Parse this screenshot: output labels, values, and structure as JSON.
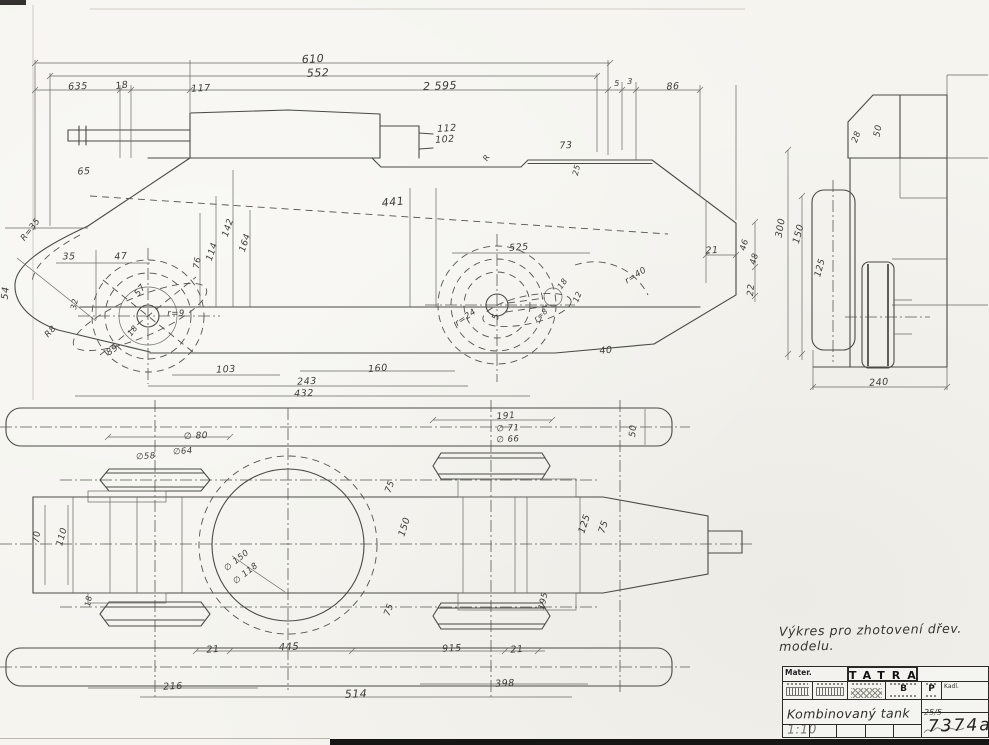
{
  "sheet": {
    "note": "Výkres pro zhotovení dřev. modelu.",
    "colors": {
      "paper": "#f5f4ef",
      "ink": "#4a4a46",
      "dark": "#161614"
    }
  },
  "title_block": {
    "mater_label": "Mater.",
    "brand": "TATRA",
    "cell_b": "B",
    "cell_p": "P",
    "kadl_label": "Kadl.",
    "drawing_title": "Kombinovaný tank 1:10",
    "date": "25/5",
    "drawing_number": "7374a"
  },
  "labels": [
    {
      "t": "635",
      "x": 78,
      "y": 87,
      "r": -2
    },
    {
      "t": "18",
      "x": 122,
      "y": 86,
      "r": -8
    },
    {
      "t": "117",
      "x": 201,
      "y": 89,
      "r": -3
    },
    {
      "t": "610",
      "x": 313,
      "y": 59,
      "r": -3,
      "fs": 11
    },
    {
      "t": "552",
      "x": 318,
      "y": 73,
      "r": -2,
      "fs": 11
    },
    {
      "t": "2 595",
      "x": 440,
      "y": 86,
      "r": -2,
      "fs": 11
    },
    {
      "t": "5",
      "x": 617,
      "y": 84,
      "r": 0,
      "fs": 8
    },
    {
      "t": "3",
      "x": 630,
      "y": 82,
      "r": 0,
      "fs": 8
    },
    {
      "t": "86",
      "x": 673,
      "y": 87,
      "r": -3
    },
    {
      "t": "112",
      "x": 447,
      "y": 129,
      "r": -4
    },
    {
      "t": "102",
      "x": 445,
      "y": 140,
      "r": -4
    },
    {
      "t": "73",
      "x": 566,
      "y": 146,
      "r": -3
    },
    {
      "t": "25",
      "x": 577,
      "y": 170,
      "r": -78,
      "fs": 8
    },
    {
      "t": "R",
      "x": 487,
      "y": 158,
      "r": -60,
      "fs": 8
    },
    {
      "t": "65",
      "x": 84,
      "y": 172,
      "r": -3
    },
    {
      "t": "R=35",
      "x": 31,
      "y": 230,
      "r": -52,
      "fs": 8.5
    },
    {
      "t": "35",
      "x": 69,
      "y": 257,
      "r": 0
    },
    {
      "t": "47",
      "x": 121,
      "y": 257,
      "r": -5
    },
    {
      "t": "57",
      "x": 141,
      "y": 291,
      "r": -52,
      "fs": 9
    },
    {
      "t": "54",
      "x": 6,
      "y": 293,
      "r": -85
    },
    {
      "t": "32",
      "x": 75,
      "y": 304,
      "r": -80,
      "fs": 8
    },
    {
      "t": "r=9",
      "x": 176,
      "y": 314,
      "r": 0,
      "fs": 8.5
    },
    {
      "t": "R8",
      "x": 51,
      "y": 332,
      "r": -48,
      "fs": 8.5
    },
    {
      "t": "18",
      "x": 133,
      "y": 331,
      "r": -52,
      "fs": 8
    },
    {
      "t": "89",
      "x": 113,
      "y": 351,
      "r": -35,
      "fs": 9
    },
    {
      "t": "76",
      "x": 198,
      "y": 263,
      "r": -80,
      "fs": 8.5
    },
    {
      "t": "114",
      "x": 213,
      "y": 252,
      "r": -72,
      "fs": 9
    },
    {
      "t": "142",
      "x": 229,
      "y": 228,
      "r": -72,
      "fs": 9
    },
    {
      "t": "164",
      "x": 246,
      "y": 243,
      "r": -72,
      "fs": 9
    },
    {
      "t": "441",
      "x": 393,
      "y": 202,
      "r": -6,
      "fs": 11
    },
    {
      "t": "525",
      "x": 519,
      "y": 248,
      "r": -4,
      "fs": 9.5
    },
    {
      "t": "r=24",
      "x": 466,
      "y": 318,
      "r": -35,
      "fs": 8.5
    },
    {
      "t": "r=40",
      "x": 636,
      "y": 276,
      "r": -32,
      "fs": 8.5
    },
    {
      "t": "40",
      "x": 606,
      "y": 351,
      "r": -6
    },
    {
      "t": "18",
      "x": 563,
      "y": 284,
      "r": -55,
      "fs": 8
    },
    {
      "t": "12",
      "x": 578,
      "y": 297,
      "r": -68,
      "fs": 8
    },
    {
      "t": "5",
      "x": 497,
      "y": 317,
      "r": -75,
      "fs": 9
    },
    {
      "t": "r=8",
      "x": 541,
      "y": 315,
      "r": -40,
      "fs": 7.5
    },
    {
      "t": "21",
      "x": 712,
      "y": 251,
      "r": -3
    },
    {
      "t": "103",
      "x": 226,
      "y": 370,
      "r": -3
    },
    {
      "t": "160",
      "x": 378,
      "y": 369,
      "r": -5
    },
    {
      "t": "243",
      "x": 307,
      "y": 382,
      "r": -3
    },
    {
      "t": "432",
      "x": 304,
      "y": 394,
      "r": -2
    },
    {
      "t": "22",
      "x": 752,
      "y": 290,
      "r": -85,
      "fs": 9
    },
    {
      "t": "46",
      "x": 745,
      "y": 245,
      "r": -75,
      "fs": 8.5
    },
    {
      "t": "48",
      "x": 755,
      "y": 259,
      "r": -75,
      "fs": 8.5
    },
    {
      "t": "300",
      "x": 781,
      "y": 228,
      "r": -80,
      "fs": 9.5
    },
    {
      "t": "150",
      "x": 799,
      "y": 234,
      "r": -75,
      "fs": 9.5
    },
    {
      "t": "28",
      "x": 857,
      "y": 137,
      "r": -70,
      "fs": 8.5
    },
    {
      "t": "50",
      "x": 879,
      "y": 131,
      "r": -80,
      "fs": 9
    },
    {
      "t": "125",
      "x": 821,
      "y": 268,
      "r": -75,
      "fs": 9
    },
    {
      "t": "240",
      "x": 879,
      "y": 383,
      "r": -4
    },
    {
      "t": "∅ 80",
      "x": 196,
      "y": 437,
      "r": -3,
      "fs": 9
    },
    {
      "t": "∅64",
      "x": 183,
      "y": 452,
      "r": -4,
      "fs": 8.5
    },
    {
      "t": "∅58",
      "x": 146,
      "y": 457,
      "r": -4,
      "fs": 8.5
    },
    {
      "t": "191",
      "x": 506,
      "y": 417,
      "r": -4,
      "fs": 9
    },
    {
      "t": "∅ 71",
      "x": 508,
      "y": 429,
      "r": -3,
      "fs": 8.5
    },
    {
      "t": "∅ 66",
      "x": 508,
      "y": 440,
      "r": -3,
      "fs": 8.5
    },
    {
      "t": "50",
      "x": 634,
      "y": 431,
      "r": -85,
      "fs": 9
    },
    {
      "t": "70",
      "x": 38,
      "y": 537,
      "r": -85,
      "fs": 9
    },
    {
      "t": "110",
      "x": 63,
      "y": 537,
      "r": -75,
      "fs": 9
    },
    {
      "t": "18",
      "x": 89,
      "y": 601,
      "r": -80,
      "fs": 8
    },
    {
      "t": "75",
      "x": 391,
      "y": 487,
      "r": -70,
      "fs": 9
    },
    {
      "t": "75",
      "x": 390,
      "y": 610,
      "r": -70,
      "fs": 9
    },
    {
      "t": "150",
      "x": 405,
      "y": 527,
      "r": -72,
      "fs": 9.5
    },
    {
      "t": "125",
      "x": 585,
      "y": 524,
      "r": -72,
      "fs": 9.5
    },
    {
      "t": "75",
      "x": 604,
      "y": 527,
      "r": -72,
      "fs": 9.5
    },
    {
      "t": "195",
      "x": 544,
      "y": 601,
      "r": -78,
      "fs": 8.5
    },
    {
      "t": "∅ 150",
      "x": 237,
      "y": 561,
      "r": -38,
      "fs": 8.5
    },
    {
      "t": "∅ 118",
      "x": 246,
      "y": 574,
      "r": -38,
      "fs": 8.5
    },
    {
      "t": "21",
      "x": 213,
      "y": 650,
      "r": -4
    },
    {
      "t": "445",
      "x": 289,
      "y": 648,
      "r": -3,
      "fs": 10
    },
    {
      "t": "915",
      "x": 452,
      "y": 649,
      "r": -3
    },
    {
      "t": "21",
      "x": 517,
      "y": 650,
      "r": -4
    },
    {
      "t": "216",
      "x": 173,
      "y": 687,
      "r": -3
    },
    {
      "t": "514",
      "x": 356,
      "y": 694,
      "r": -2,
      "fs": 11
    },
    {
      "t": "398",
      "x": 505,
      "y": 684,
      "r": -3
    }
  ]
}
